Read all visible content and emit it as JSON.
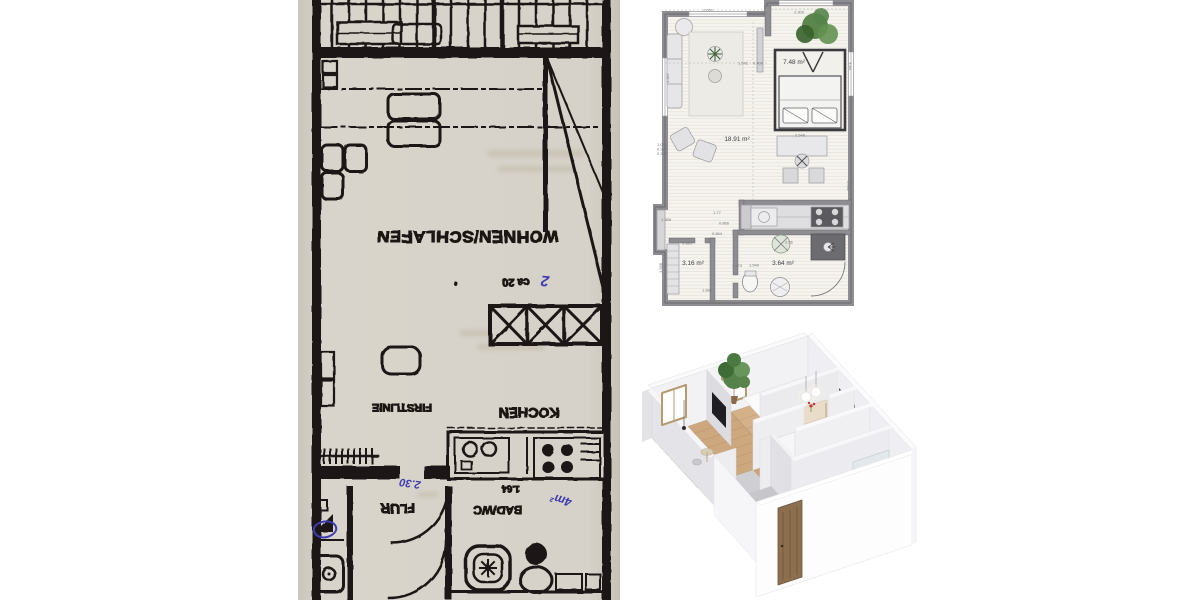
{
  "scanned_plan": {
    "labels": {
      "living": "WOHNEN/SCHLAFEN",
      "living_area_note": "ca 20",
      "kitchen": "KOCHEN",
      "ridge_line": "FIRSTLINIE",
      "hall": "FLUR",
      "bath": "BAD/WC",
      "bath_size": "1.64"
    },
    "handwriting": {
      "hall_width": "2.30",
      "bath_area": "4m²",
      "living_mark": "2"
    },
    "colors": {
      "paper": "#d6d2c9",
      "ink": "#1b1712",
      "pen": "#3c3cb0"
    }
  },
  "modern_plan": {
    "areas": {
      "living": "18.91 m²",
      "bedroom": "7.48 m²",
      "hall": "3.16 m²",
      "bath": "3.64 m²"
    },
    "dims": {
      "top_left": "2.652",
      "top_right": "2.300",
      "mid_a": "1.542",
      "mid_b": "0.400",
      "bed_right": "3.40",
      "left_top": "1.457",
      "desk": "2.548",
      "right_mid": "2.511",
      "left_a": "1.030",
      "left_b": "0.938",
      "left_c": "0.339",
      "left_d": "1.388",
      "notch": "0.883",
      "kit_a": "1.77",
      "kit_b": "0.866",
      "kit_c": "0.864",
      "hall_a": "1.473",
      "hall_b": "1.549",
      "hall_w": "1.890",
      "bath_door": "2.56",
      "left_e": "1.598"
    },
    "colors": {
      "wall": "#8e8e92",
      "floor": "#f6f4ef"
    }
  },
  "render_3d": {
    "colors": {
      "wall": "#f2f2f5",
      "wood_floor": "#cda87f",
      "gray_floor": "#c8c8cd",
      "door": "#8b6f4e"
    }
  }
}
